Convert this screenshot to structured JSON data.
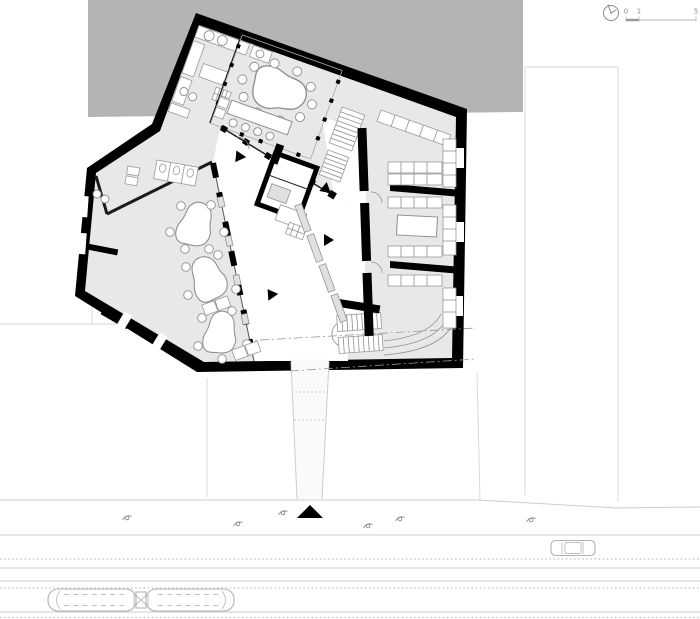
{
  "drawing": {
    "type": "architectural ground floor plan with street and tram line",
    "scale_bar": {
      "tick_start": "0",
      "tick_mid": "1",
      "tick_end": "5"
    }
  },
  "colors": {
    "wall": "#000000",
    "context_block": "#b4b4b4",
    "room_floor": "#e8e8e8",
    "hall_floor": "#ffffff",
    "furniture_stroke": "#8f8f8f",
    "light_line": "#cccccc",
    "paper": "#ffffff"
  },
  "site": {
    "vehicles": [
      "tram",
      "car"
    ],
    "pedestrian_count": 6,
    "entrance_marker": "black triangle"
  },
  "icons": {
    "north_indicator": "north-indicator-icon",
    "scale_bar": "scale-bar"
  }
}
